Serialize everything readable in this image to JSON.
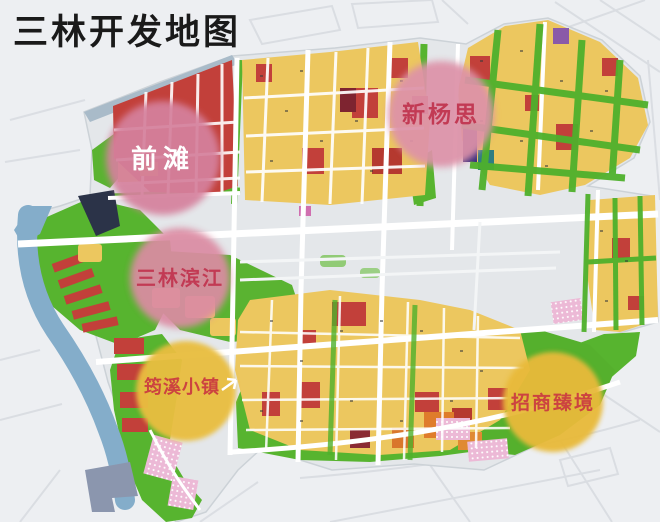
{
  "title": "三林开发地图",
  "map": {
    "name": "三林开发地图",
    "districts": [
      {
        "id": "qiantan",
        "label": "前滩",
        "circle_color": "#d5819d",
        "label_color": "#ffffff"
      },
      {
        "id": "xinyangsi",
        "label": "新杨思",
        "circle_color": "#dd92a8",
        "label_color": "#c23a54"
      },
      {
        "id": "sanlin-binjiang",
        "label": "三林滨江",
        "circle_color": "#db8ba3",
        "label_color": "#c23a54"
      },
      {
        "id": "junxi-xiaozhen",
        "label": "筠溪小镇",
        "circle_color": "#e9be3f",
        "label_color": "#cc4340"
      },
      {
        "id": "zhaoshang-zhenjing",
        "label": "招商臻境",
        "circle_color": "#e8ba3a",
        "label_color": "#cc4340"
      }
    ],
    "palette": {
      "title_color": "#1a1a1a",
      "residential_yellow": "#ecc75f",
      "commercial_red": "#c2403a",
      "park_green": "#57b42f",
      "river_blue": "#84adca",
      "road_white": "#ffffff",
      "background_gray": "#edeff2",
      "pier_slate": "#8b96ae",
      "elevated_road_gray": "#a9bbc9"
    }
  }
}
